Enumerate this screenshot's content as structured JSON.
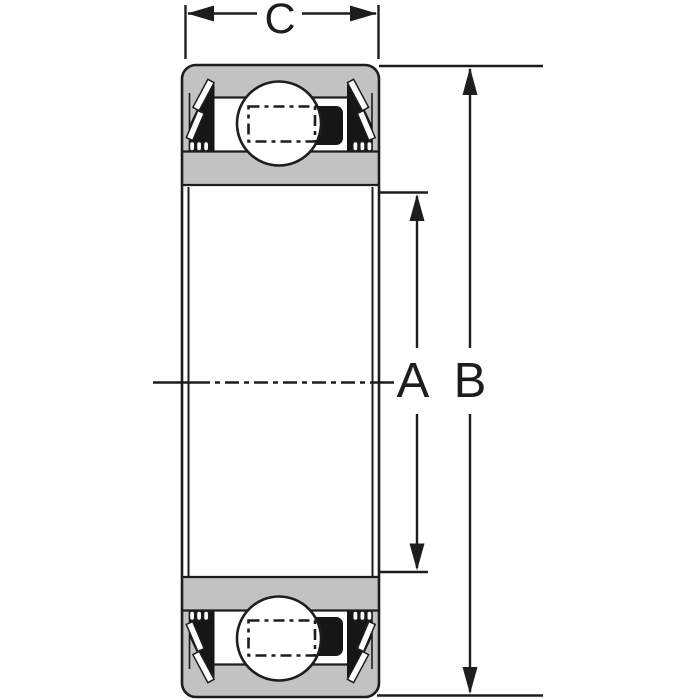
{
  "diagram": {
    "type": "sealed deep-groove ball bearing cross-section",
    "dimension_labels": {
      "bore_diameter": "A",
      "outer_diameter": "B",
      "width": "C"
    },
    "colors": {
      "background": "#ffffff",
      "ring_fill": "#c2c2c2",
      "seal_fill": "#161616",
      "line": "#1d1d1d"
    }
  }
}
